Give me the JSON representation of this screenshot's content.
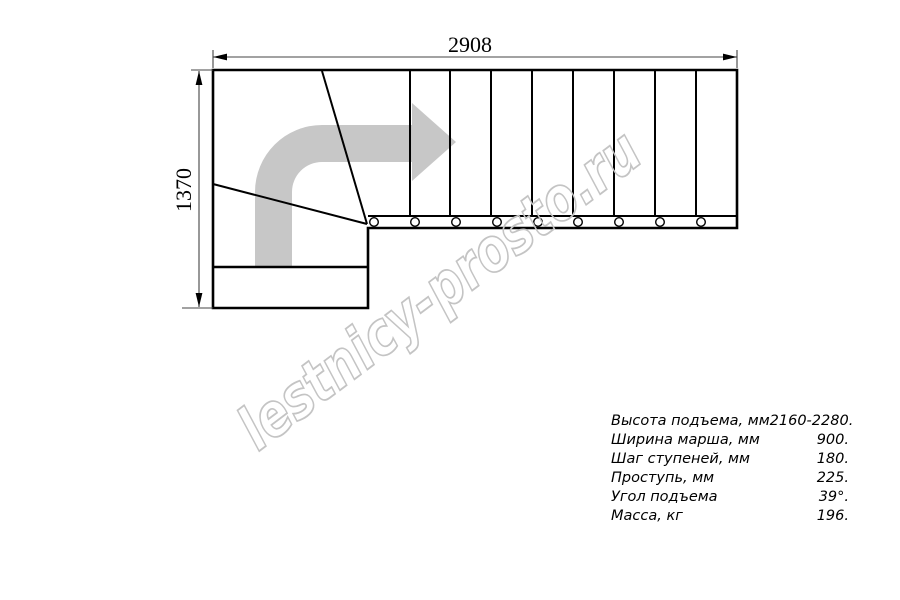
{
  "drawing": {
    "title": "stair-plan-top-view",
    "width_dim_label": "2908",
    "height_dim_label": "1370"
  },
  "watermark": {
    "text": "lestnicy-prosto.ru",
    "color": "#c4c4c4"
  },
  "colors": {
    "line": "#000000",
    "dimension_line": "#444444",
    "direction_arrow": "#c7c7c7"
  },
  "specs": {
    "rows": [
      {
        "label": "Высота подъема, мм",
        "value": "2160-2280."
      },
      {
        "label": "Ширина марша, мм",
        "value": "900."
      },
      {
        "label": "Шаг ступеней, мм",
        "value": "180."
      },
      {
        "label": "Проступь, мм",
        "value": "225."
      },
      {
        "label": "Угол подъема",
        "value": "39°."
      },
      {
        "label": "Масса, кг",
        "value": "196."
      }
    ]
  }
}
